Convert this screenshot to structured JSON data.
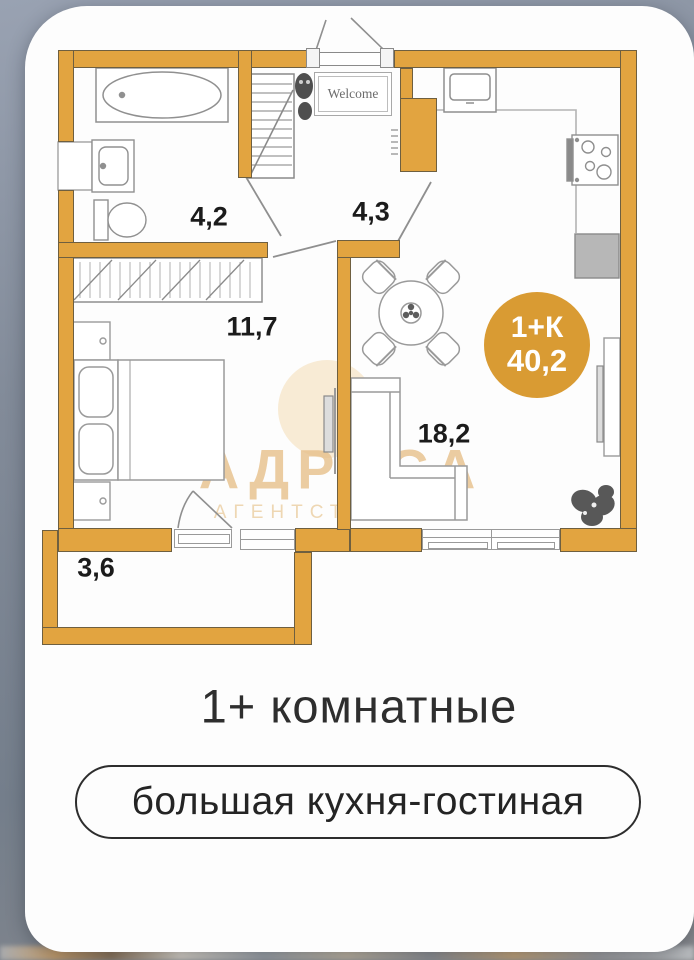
{
  "plan": {
    "welcome_mat": "Welcome",
    "rooms": [
      {
        "id": "bathroom",
        "area": "4,2"
      },
      {
        "id": "hallway",
        "area": "4,3"
      },
      {
        "id": "bedroom",
        "area": "11,7"
      },
      {
        "id": "living-kitchen",
        "area": "18,2"
      },
      {
        "id": "balcony",
        "area": "3,6"
      }
    ],
    "badge": {
      "layout": "1+К",
      "total_area": "40,2"
    },
    "colors": {
      "wall": "#E2A440",
      "badge": "#D99B33",
      "watermark": "#E7C08B"
    }
  },
  "watermark": {
    "title": "АДРЕСА",
    "subtitle": "АГЕНТСТВО Н"
  },
  "caption": {
    "title": "1+ комнатные",
    "pill": "большая кухня-гостиная"
  }
}
